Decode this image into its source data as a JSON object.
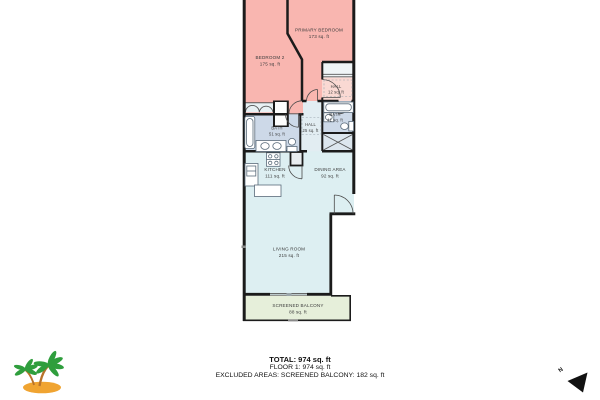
{
  "floorplan": {
    "rooms": [
      {
        "id": "primary-bedroom",
        "name": "PRIMARY BEDROOM",
        "area": "173 sq. ft"
      },
      {
        "id": "bedroom-2",
        "name": "BEDROOM 2",
        "area": "175 sq. ft"
      },
      {
        "id": "hall-12",
        "name": "HALL",
        "area": "12 sq. ft"
      },
      {
        "id": "bath-41",
        "name": "BATH",
        "area": "41 sq. ft"
      },
      {
        "id": "hall-25",
        "name": "HALL",
        "area": "25 sq. ft"
      },
      {
        "id": "bath-51",
        "name": "BATH",
        "area": "51 sq. ft"
      },
      {
        "id": "kitchen",
        "name": "KITCHEN",
        "area": "111 sq. ft"
      },
      {
        "id": "dining-area",
        "name": "DINING AREA",
        "area": "92 sq. ft"
      },
      {
        "id": "living-room",
        "name": "LIVING ROOM",
        "area": "215 sq. ft"
      },
      {
        "id": "screened-balcony",
        "name": "SCREENED BALCONY",
        "area": "88 sq. ft"
      }
    ],
    "colors": {
      "bedroom_pink": "#f9b6b0",
      "suite_hall_pink": "#fad9d3",
      "bath_blue": "#cdd9e8",
      "hall_blue": "#e2edf2",
      "living_blue": "#ddeff2",
      "balcony_green": "#e6efda",
      "closet_blue": "#dce6ee",
      "wall": "#1b1b1b",
      "label": "#3c3c3c"
    },
    "compass": {
      "label": "N"
    },
    "icons": {
      "logo": "palm-trees",
      "compass": "north-arrow"
    }
  },
  "footer": {
    "total": "TOTAL: 974 sq. ft",
    "floor1": "FLOOR 1: 974 sq. ft",
    "excluded": "EXCLUDED AREAS: SCREENED BALCONY: 182 sq. ft"
  }
}
